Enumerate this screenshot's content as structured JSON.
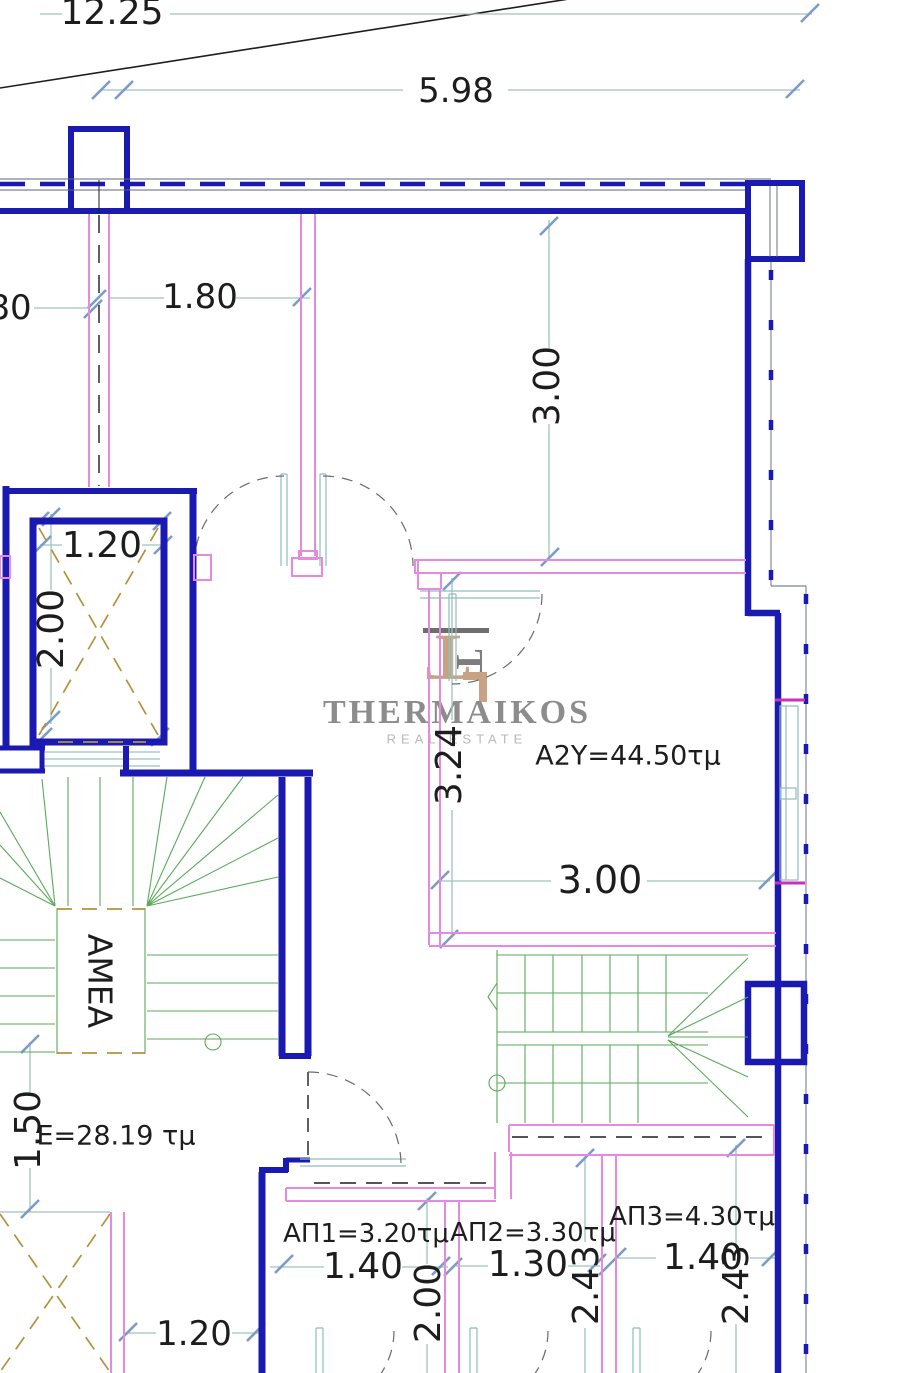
{
  "drawing": {
    "type": "architectural-floor-plan",
    "watermark": {
      "name": "THERMAIKOS",
      "tagline": "REAL ESTATE"
    },
    "labels": {
      "apartment": "A2Y=44.50τμ",
      "common_area": "E=28.19 τμ",
      "accessible_lift": "AMEA",
      "storage1": "ΑΠ1=3.20τμ",
      "storage2": "ΑΠ2=3.30τμ",
      "storage3": "ΑΠ3=4.30τμ"
    },
    "dimensions": {
      "d_12_25": "12.25",
      "d_5_98": "5.98",
      "d_80": "80",
      "d_1_80": "1.80",
      "d_3_00_v": "3.00",
      "d_1_20_elevator": "1.20",
      "d_2_00_elevator": "2.00",
      "d_3_24": "3.24",
      "d_3_00_h": "3.00",
      "d_1_50": "1.50",
      "d_1_20_bottom": "1.20",
      "d_1_40_ap1": "1.40",
      "d_2_00_ap1": "2.00",
      "d_1_30_ap2": "1.30",
      "d_2_43_ap2": "2.43",
      "d_1_40_ap3": "1.40",
      "d_2_43_ap3": "2.43"
    },
    "colors": {
      "wall_blue": "#1a1ab2",
      "partition_pink": "#e888e0",
      "accent_magenta": "#cc2ebe",
      "dimension_teal": "#9dc3bd",
      "tick_blue": "#7b9cc9",
      "stair_green": "#5aaa5a",
      "hatch_olive": "#b3923d",
      "slope_red": "#b24848",
      "logo_tan": "#c8a285",
      "logo_gray": "#8c8c8c",
      "text_black": "#1d1d1d"
    }
  }
}
